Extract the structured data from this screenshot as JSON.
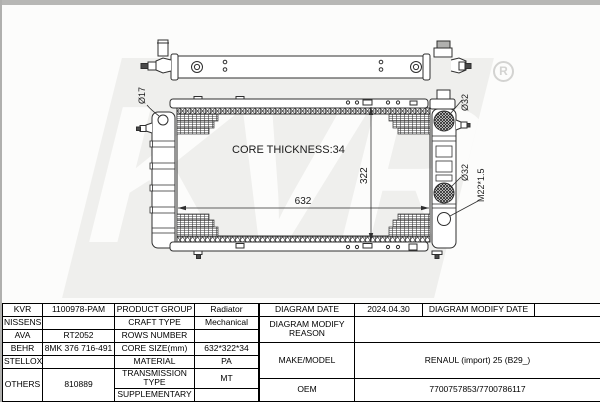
{
  "watermark": {
    "text": "KVR",
    "registered": "R"
  },
  "drawing": {
    "core_thickness": "CORE THICKNESS:34",
    "width_dim": "632",
    "height_dim": "322",
    "inlet_left_label": "Ø17",
    "port_top_right_label": "Ø32",
    "port_mid_right_label": "Ø32",
    "drain_thread_label": "M22*1.5"
  },
  "colors": {
    "line": "#2f2f2f",
    "top_strip": "#b7b7b5",
    "watermark_block": "#efefed",
    "watermark_text": "#fcfcfb",
    "table_border": "#000000"
  },
  "table": {
    "left": {
      "rows": [
        {
          "brand": "KVR",
          "brand_value": "1100978-PAM",
          "label": "PRODUCT GROUP",
          "value": "Radiator"
        },
        {
          "brand": "NISSENS",
          "brand_value": "",
          "label": "CRAFT TYPE",
          "value": "Mechanical"
        },
        {
          "brand": "AVA",
          "brand_value": "RT2052",
          "label": "ROWS NUMBER",
          "value": ""
        },
        {
          "brand": "BEHR",
          "brand_value": "8MK 376 716-491",
          "label": "CORE SIZE(mm)",
          "value": "632*322*34"
        },
        {
          "brand": "STELLOX",
          "brand_value": "",
          "label": "MATERIAL",
          "value": "PA"
        },
        {
          "brand": "OTHERS",
          "brand_value": "810889",
          "label": "TRANSMISSION TYPE",
          "value": "MT"
        },
        {
          "label": "SUPPLEMENTARY",
          "value": ""
        }
      ]
    },
    "right": {
      "diagram_date_label": "DIAGRAM DATE",
      "diagram_date": "2024.04.30",
      "diagram_modify_date_label": "DIAGRAM MODIFY DATE",
      "diagram_modify_date": "",
      "modify_reason_label": "DIAGRAM MODIFY REASON",
      "modify_reason": "",
      "make_model_label": "MAKE/MODEL",
      "make_model": "RENAUL (import) 25 (B29_)",
      "oem_label": "OEM",
      "oem": "7700757853/7700786117"
    }
  }
}
